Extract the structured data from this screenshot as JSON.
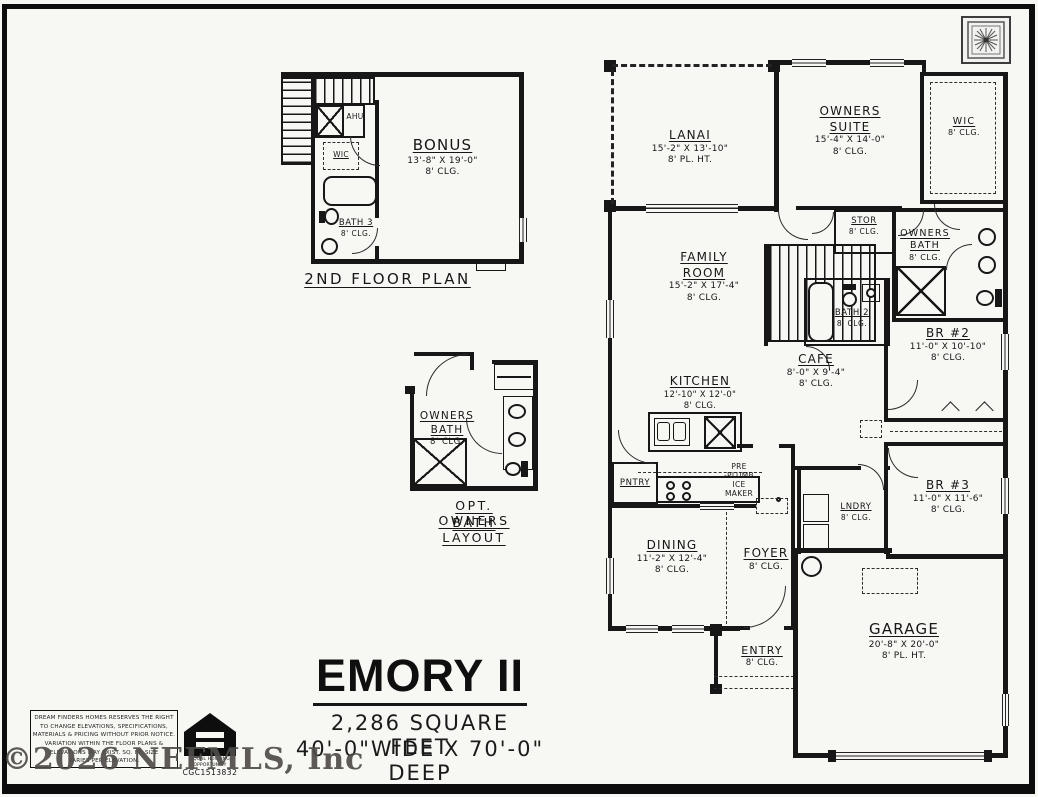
{
  "watermark": "©2026 NEFMLS, Inc",
  "title_block": {
    "plan_name": "EMORY II",
    "square_feet": "2,286 SQUARE FEET",
    "dimensions": "40'-0\"WIDE X 70'-0\" DEEP"
  },
  "second_floor_plan": {
    "caption": "2ND FLOOR PLAN",
    "rooms": {
      "bonus": {
        "name": "BONUS",
        "dims": "13'-8\" X 19'-0\"",
        "ceiling": "8' CLG."
      },
      "ahu": {
        "name": "AHU"
      },
      "wic": {
        "name": "WIC"
      },
      "bath3": {
        "name": "BATH 3",
        "ceiling": "8' CLG."
      }
    }
  },
  "opt_bath_plan": {
    "caption_line1": "OPT. OWNERS",
    "caption_line2": "BATH LAYOUT",
    "room": {
      "name1": "OWNERS",
      "name2": "BATH",
      "ceiling": "8' CLG."
    }
  },
  "main_plan": {
    "rooms": {
      "lanai": {
        "name": "LANAI",
        "dims": "15'-2\" X 13'-10\"",
        "ceiling": "8' PL. HT."
      },
      "owners_suite": {
        "name1": "OWNERS",
        "name2": "SUITE",
        "dims": "15'-4\" X 14'-0\"",
        "ceiling": "8' CLG."
      },
      "wic": {
        "name": "WIC",
        "ceiling": "8' CLG."
      },
      "stor": {
        "name": "STOR",
        "ceiling": "8' CLG."
      },
      "owners_bath": {
        "name1": "OWNERS",
        "name2": "BATH",
        "ceiling": "8' CLG."
      },
      "family_room": {
        "name1": "FAMILY",
        "name2": "ROOM",
        "dims": "15'-2\" X 17'-4\"",
        "ceiling": "8' CLG."
      },
      "bath2": {
        "name": "BATH 2",
        "ceiling": "8' CLG."
      },
      "br2": {
        "name": "BR #2",
        "dims": "11'-0\" X 10'-10\"",
        "ceiling": "8' CLG."
      },
      "cafe": {
        "name": "CAFE",
        "dims": "8'-0\" X 9'-4\"",
        "ceiling": "8' CLG."
      },
      "kitchen": {
        "name": "KITCHEN",
        "dims": "12'-10\" X 12'-0\"",
        "ceiling": "8' CLG."
      },
      "pantry": {
        "name": "PNTRY"
      },
      "ice_maker": {
        "l1": "PRE",
        "l2": "-PLUMB",
        "l3": "ICE",
        "l4": "MAKER"
      },
      "lndry": {
        "name": "LNDRY",
        "ceiling": "8' CLG."
      },
      "br3": {
        "name": "BR #3",
        "dims": "11'-0\" X 11'-6\"",
        "ceiling": "8' CLG."
      },
      "dining": {
        "name": "DINING",
        "dims": "11'-2\" X 12'-4\"",
        "ceiling": "8' CLG."
      },
      "foyer": {
        "name": "FOYER",
        "ceiling": "8' CLG."
      },
      "entry": {
        "name": "ENTRY",
        "ceiling": "8' CLG."
      },
      "garage": {
        "name": "GARAGE",
        "dims": "20'-8\" X 20'-0\"",
        "ceiling": "8' PL. HT."
      }
    }
  },
  "footer": {
    "disclaimer_lines": [
      "DREAM FINDERS HOMES RESERVES THE RIGHT",
      "TO CHANGE ELEVATIONS, SPECIFICATIONS,",
      "MATERIALS & PRICING WITHOUT PRIOR NOTICE.",
      "VARIATION WITHIN THE FLOOR PLANS &",
      "ELEVATIONS MAY EXIST. SQ. FT. SIZE",
      "VARIES PER ELEVATION."
    ],
    "equal_housing_line1": "EQUAL HOUSING",
    "equal_housing_line2": "OPPORTUNITY",
    "license": "CGC1513832"
  },
  "icons": {
    "corner_medallion": "compass-medallion",
    "equal_housing": "equal-housing-logo"
  },
  "colors": {
    "wall": "#171717",
    "paper": "#f7f7f4",
    "watermark": "#4f4c49"
  }
}
